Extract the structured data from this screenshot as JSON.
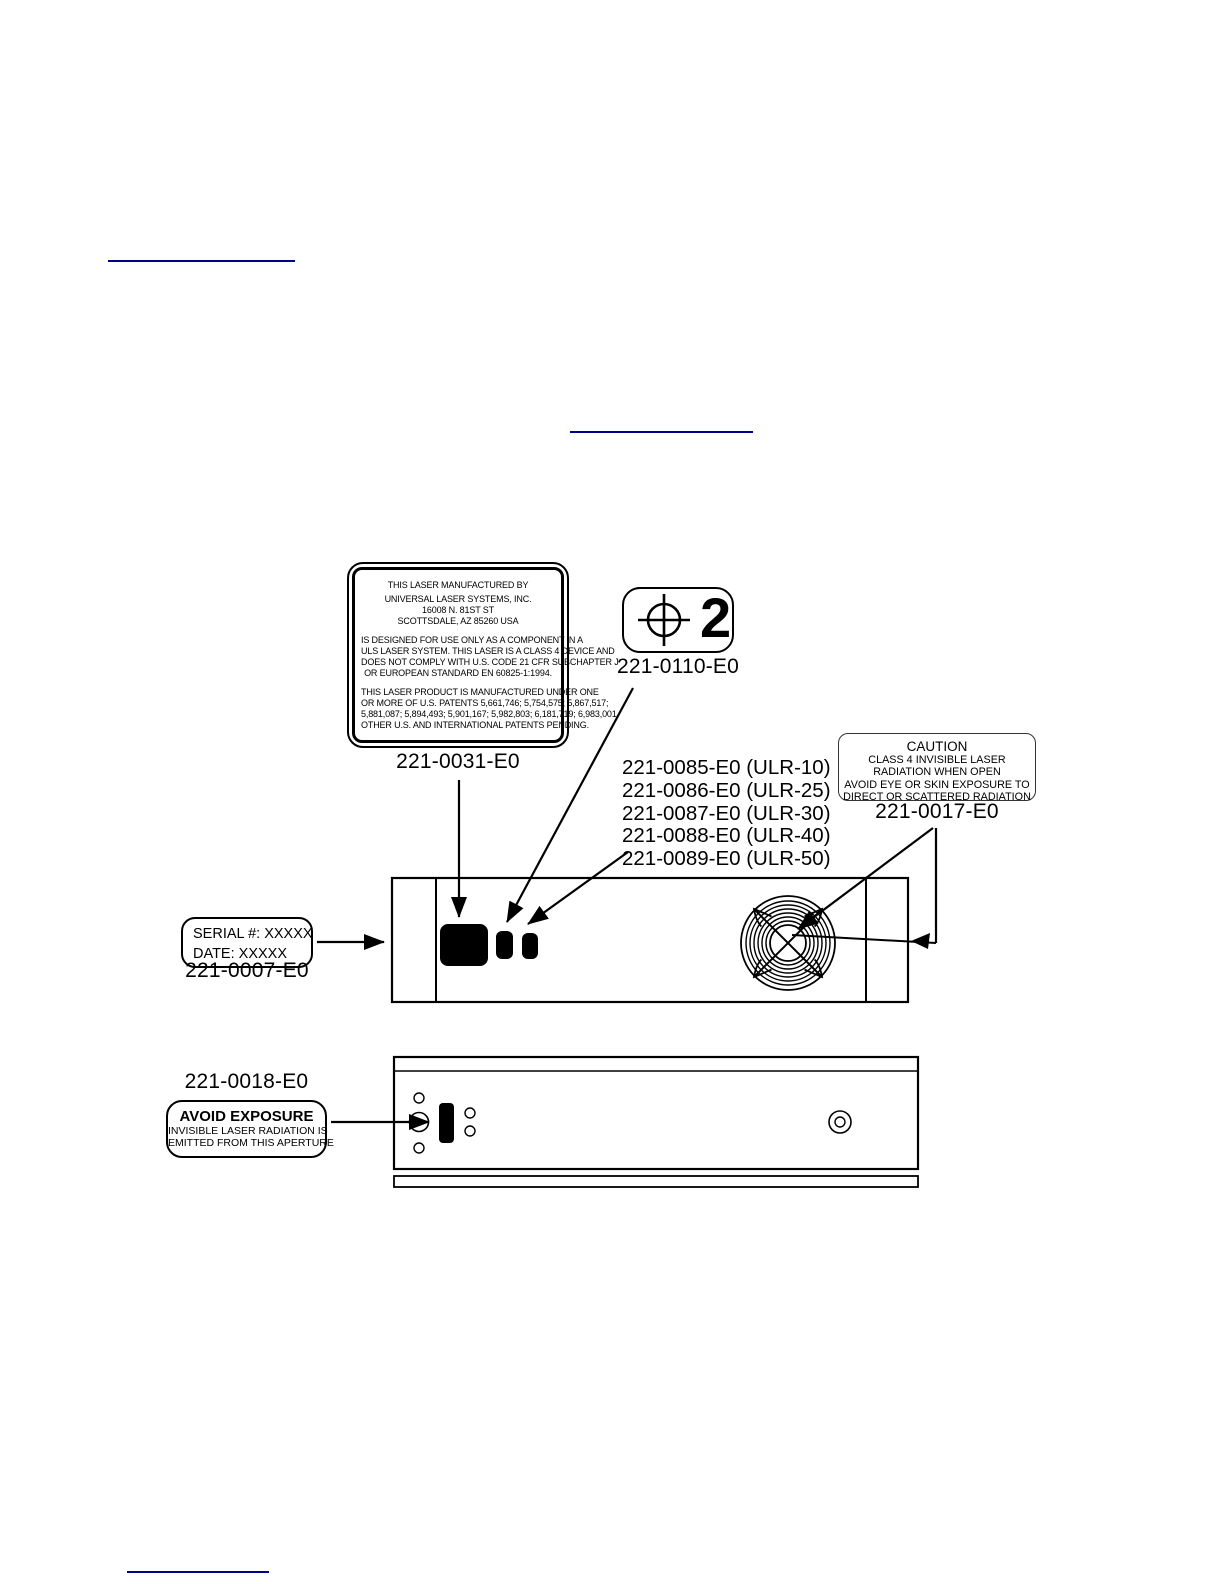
{
  "page": {
    "background_color": "#ffffff",
    "link_color": "#00008B",
    "ink_color": "#000000"
  },
  "links": {
    "top_rule": "",
    "middle_rule": "",
    "bottom_rule": ""
  },
  "manufacturer_label": {
    "part_number": "221-0031-E0",
    "para1": [
      "THIS LASER MANUFACTURED BY",
      "UNIVERSAL LASER SYSTEMS, INC.",
      "16008 N. 81ST ST",
      "SCOTTSDALE, AZ 85260 USA"
    ],
    "para2": [
      "IS DESIGNED FOR USE ONLY AS A COMPONENT IN A",
      "ULS LASER SYSTEM. THIS LASER IS A CLASS 4 DEVICE AND",
      "DOES NOT COMPLY WITH U.S. CODE 21 CFR SUBCHAPTER J",
      "OR EUROPEAN STANDARD EN 60825-1:1994."
    ],
    "para3": [
      "THIS LASER PRODUCT IS MANUFACTURED UNDER ONE",
      "OR MORE OF U.S. PATENTS 5,661,746; 5,754,575; 5,867,517;",
      "5,881,087; 5,894,493; 5,901,167; 5,982,803; 6,181,719; 6,983,001",
      "OTHER U.S. AND INTERNATIONAL PATENTS PENDING."
    ]
  },
  "alignment_label": {
    "part_number": "221-0110-E0",
    "number": "2",
    "icon": "crosshair-target"
  },
  "model_labels": {
    "items": [
      "221-0085-E0 (ULR-10)",
      "221-0086-E0 (ULR-25)",
      "221-0087-E0 (ULR-30)",
      "221-0088-E0 (ULR-40)",
      "221-0089-E0 (ULR-50)"
    ]
  },
  "caution_label": {
    "part_number": "221-0017-E0",
    "title": "CAUTION",
    "lines": [
      "CLASS 4 INVISIBLE LASER",
      "RADIATION WHEN OPEN",
      "AVOID EYE OR SKIN EXPOSURE TO",
      "DIRECT OR SCATTERED RADIATION"
    ]
  },
  "serial_label": {
    "part_number": "221-0007-E0",
    "line1": "SERIAL #: XXXXX",
    "line2": "DATE: XXXXX"
  },
  "aperture_label": {
    "part_number": "221-0018-E0",
    "title": "AVOID EXPOSURE",
    "lines": [
      "INVISIBLE LASER RADIATION IS",
      "EMITTED FROM THIS APERTURE"
    ]
  }
}
